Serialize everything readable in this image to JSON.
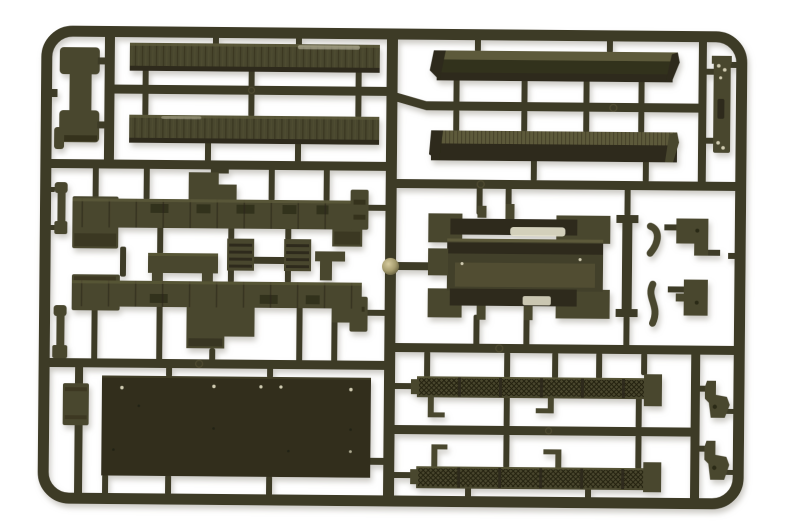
{
  "image": {
    "domain": "natural-image",
    "description": "Olive-drab plastic model kit sprue (parts tree) for a military truck, photographed on a white background",
    "alt": "Injection-molded sprue frame holding olive green truck parts: two treadplate planks, two chassis side rails, a large cargo-bed floor panel, two side beams, two mesh stake side panels, a bed subframe assembly, ladder strip, tow hooks and assorted small fittings"
  },
  "palette": {
    "background": "#ffffff",
    "runner": "#3e3b26",
    "runner_dark": "#32301d",
    "part_mid": "#4a472e",
    "part_light": "#5d5a3b",
    "part_shadow": "#2d2b1a",
    "panel_dark": "#302f1c",
    "mesh_dark": "#26250f",
    "highlight": "#e6e2cd",
    "hole_light": "#cfcab0",
    "knob": "#b3a97e",
    "shadow": "#9a968a"
  },
  "parts": {
    "frame": "sprue border frame",
    "divider": "central vertical runner",
    "knob": "injection gate knob",
    "plank_top": "treadplate plank upper",
    "plank_mid": "treadplate plank lower",
    "dogbone": "spring block part",
    "rail_upper": "chassis side rail left",
    "rail_lower": "chassis side rail right",
    "bench": "bench seat part",
    "grille1": "louvered panel A",
    "grille2": "louvered panel B",
    "bracket": "corner bracket",
    "floor_panel": "cargo bed floor panel",
    "beam_upper": "bed side beam upper",
    "beam_lower": "bed side beam lower",
    "ladder": "ladder rack strip",
    "subframe": "bed subframe assembly",
    "tow_block1": "towing bracket upper",
    "tow_block2": "towing bracket lower",
    "mesh_rail_upper": "stake side panel upper",
    "mesh_rail_lower": "stake side panel lower",
    "hook1": "tow hook upper",
    "hook2": "tow hook lower",
    "levers": "small lever parts",
    "side_block": "stowage lid part"
  }
}
